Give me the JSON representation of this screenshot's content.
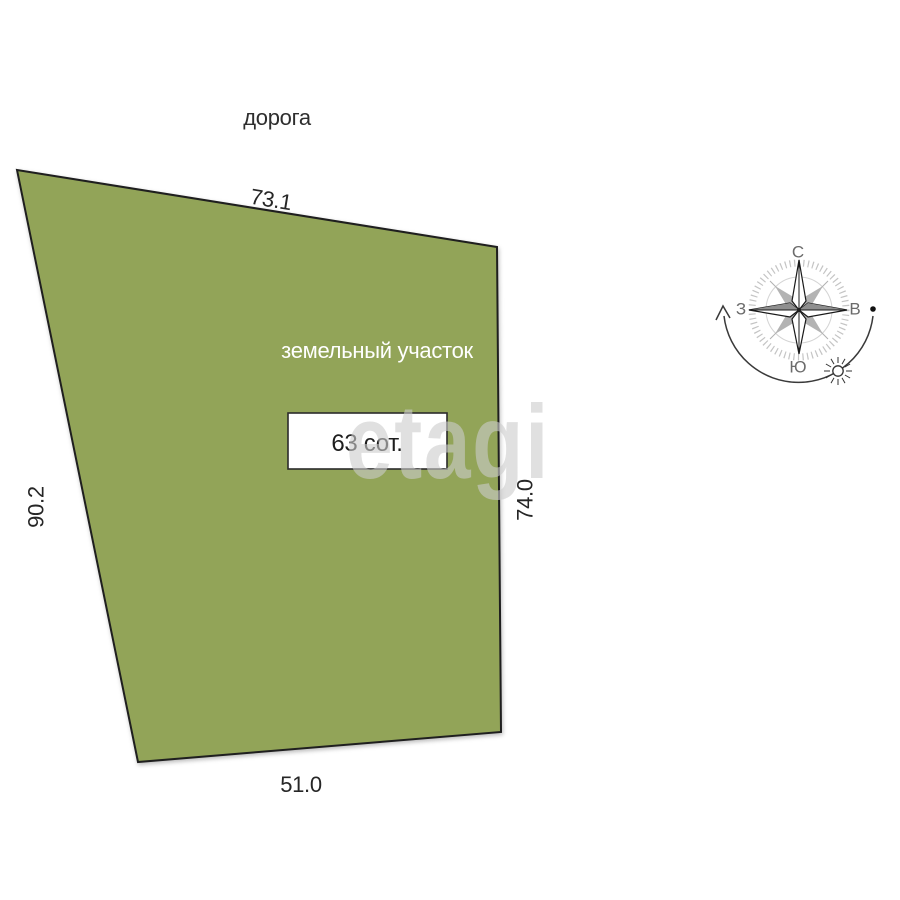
{
  "plot": {
    "road_label": "дорога",
    "name_label": "земельный участок",
    "area_value": "63 сот.",
    "dimensions": {
      "top": "73.1",
      "left": "90.2",
      "right": "74.0",
      "bottom": "51.0"
    },
    "fill_color": "#92a458",
    "outline_color": "#1f1f1f"
  },
  "compass": {
    "north": "С",
    "east": "В",
    "south": "Ю",
    "west": "З"
  },
  "watermark": {
    "text": "etagi",
    "color": "#cccccc"
  }
}
